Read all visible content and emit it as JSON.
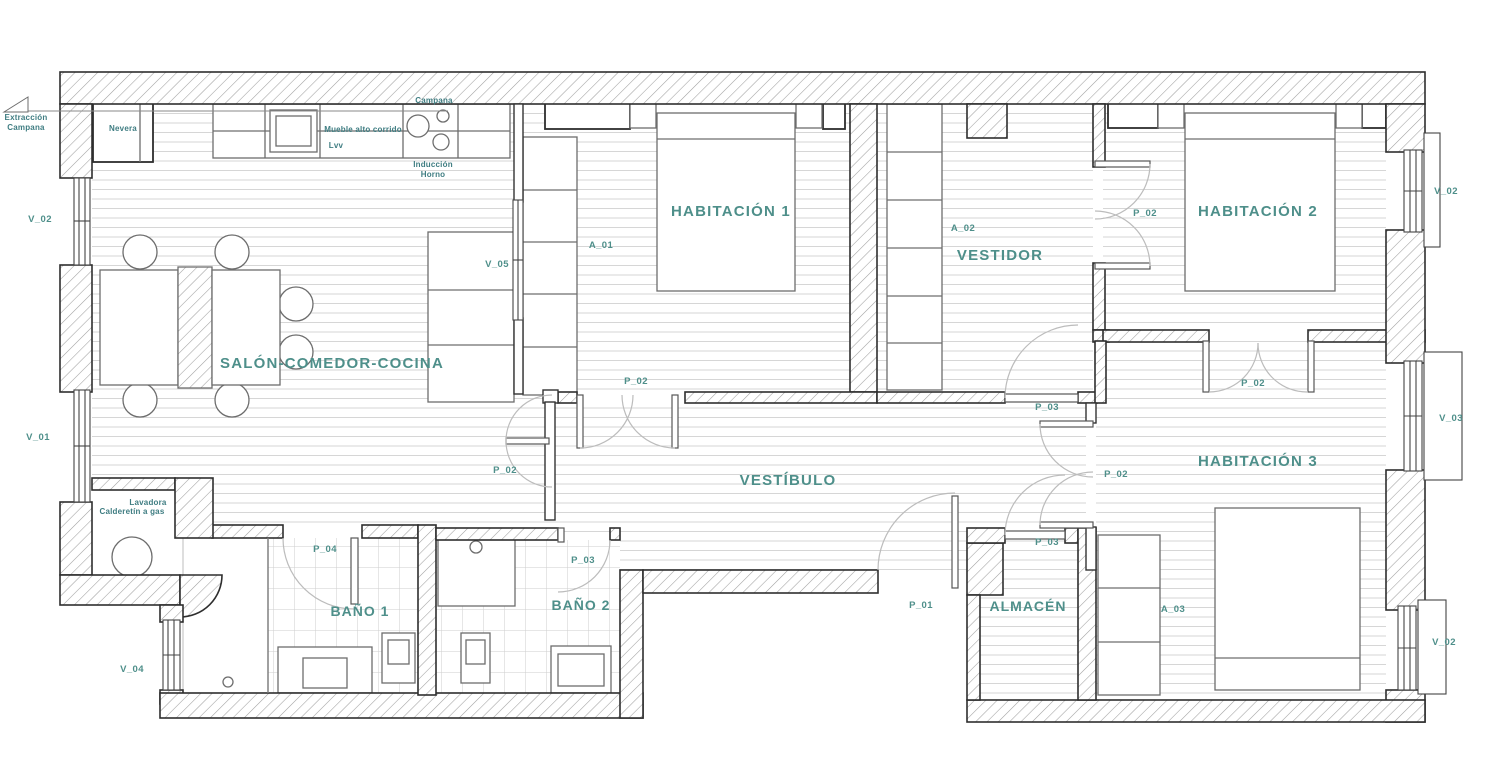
{
  "plan": {
    "accent_color": "#4e8f8a",
    "wall_color": "#2e2e2e",
    "rooms": [
      {
        "id": "salon",
        "name": "SALÓN-COMEDOR-COCINA"
      },
      {
        "id": "hab1",
        "name": "HABITACIÓN 1"
      },
      {
        "id": "vestidor",
        "name": "VESTIDOR"
      },
      {
        "id": "hab2",
        "name": "HABITACIÓN 2"
      },
      {
        "id": "vestibulo",
        "name": "VESTÍBULO"
      },
      {
        "id": "hab3",
        "name": "HABITACIÓN 3"
      },
      {
        "id": "bano1",
        "name": "BAÑO 1"
      },
      {
        "id": "bano2",
        "name": "BAÑO 2"
      },
      {
        "id": "almacen",
        "name": "ALMACÉN"
      }
    ],
    "openings": {
      "v01": "V_01",
      "v02": "V_02",
      "v03": "V_03",
      "v04": "V_04",
      "v05": "V_05",
      "p01": "P_01",
      "p02": "P_02",
      "p03": "P_03",
      "p04": "P_04",
      "a01": "A_01",
      "a02": "A_02",
      "a03": "A_03"
    },
    "kitchen": {
      "extraccion_line1": "Extracción",
      "extraccion_line2": "Campana",
      "nevera": "Nevera",
      "campana": "Campana",
      "mueble": "Mueble alto corrido",
      "lvv": "Lvv",
      "induccion": "Inducción",
      "horno": "Horno"
    },
    "utility": {
      "lavadora": "Lavadora",
      "calderetin": "Calderetín a gas"
    }
  }
}
